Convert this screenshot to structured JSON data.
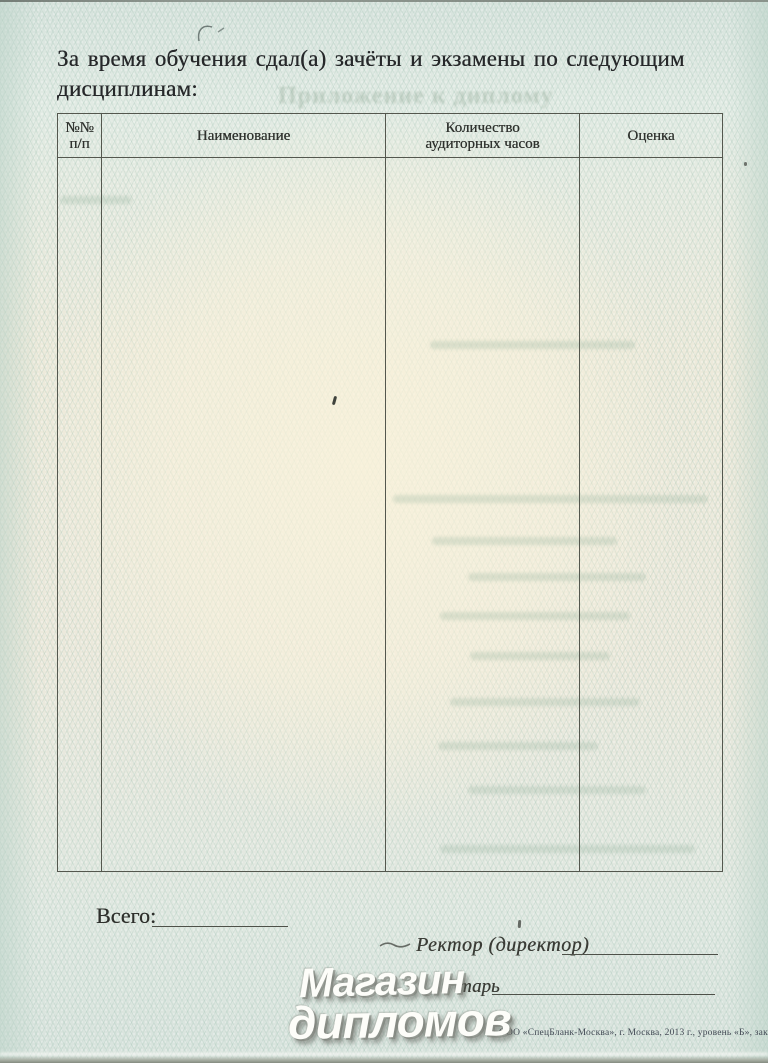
{
  "document": {
    "heading": {
      "line1": "За время обучения сдал(а) зачёты и экзамены по следующим",
      "line2": "дисциплинам:"
    },
    "bleedthrough_text": "Приложение к диплому",
    "table": {
      "columns": [
        {
          "line1": "№№",
          "line2": "п/п"
        },
        {
          "label": "Наименование"
        },
        {
          "line1": "Количество",
          "line2": "аудиторных часов"
        },
        {
          "label": "Оценка"
        }
      ],
      "rows": []
    },
    "total_label": "Всего:",
    "signatures": {
      "rector_label": "Ректор (директор)",
      "secretary_visible_text": "тарь"
    },
    "watermark": {
      "line1": "Магазин",
      "line2": "дипломов"
    },
    "imprint": "ООО «СпецБланк-Москва», г. Москва, 2013 г., уровень «Б», зак. № 260.",
    "colors": {
      "paper_edge": "#dde8e2",
      "paper_center": "#f8f3e2",
      "table_border": "#54574e",
      "ink": "#2e302c",
      "watermark": "#ffffff"
    }
  }
}
